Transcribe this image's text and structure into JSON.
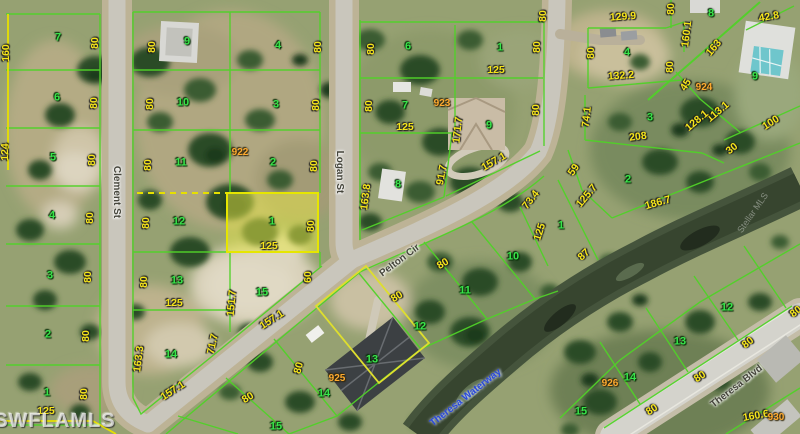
{
  "colors": {
    "lot_line": "#50d228",
    "highlight_line": "#e6e600",
    "highlight_fill": "#e8e84e",
    "dimension_text": "#f6e51a",
    "lot_number_text": "#38e44a",
    "parcel_id_text": "#ffab2e",
    "street_text": "#45453b",
    "waterway_text": "#2a49da"
  },
  "highlighted_parcel": {
    "lot": "1",
    "frontage": "125"
  },
  "labels": {
    "dimensions": [
      {
        "t": "160",
        "x": 6,
        "y": 53,
        "r": -90
      },
      {
        "t": "124",
        "x": 5,
        "y": 152,
        "r": -90
      },
      {
        "t": "125",
        "x": 46,
        "y": 411,
        "r": 0
      },
      {
        "t": "80",
        "x": 95,
        "y": 43,
        "r": -90
      },
      {
        "t": "80",
        "x": 94,
        "y": 103,
        "r": -90
      },
      {
        "t": "80",
        "x": 92,
        "y": 160,
        "r": -90
      },
      {
        "t": "80",
        "x": 90,
        "y": 218,
        "r": -90
      },
      {
        "t": "80",
        "x": 88,
        "y": 277,
        "r": -90
      },
      {
        "t": "80",
        "x": 86,
        "y": 336,
        "r": -90
      },
      {
        "t": "80",
        "x": 84,
        "y": 394,
        "r": -90
      },
      {
        "t": "80",
        "x": 152,
        "y": 47,
        "r": -90
      },
      {
        "t": "80",
        "x": 150,
        "y": 104,
        "r": -90
      },
      {
        "t": "80",
        "x": 148,
        "y": 165,
        "r": -90
      },
      {
        "t": "80",
        "x": 146,
        "y": 223,
        "r": -90
      },
      {
        "t": "80",
        "x": 144,
        "y": 282,
        "r": -90
      },
      {
        "t": "125",
        "x": 174,
        "y": 303,
        "r": 0
      },
      {
        "t": "163.3",
        "x": 139,
        "y": 359,
        "r": -83
      },
      {
        "t": "157.1",
        "x": 173,
        "y": 391,
        "r": -33
      },
      {
        "t": "71.7",
        "x": 213,
        "y": 344,
        "r": -78
      },
      {
        "t": "80",
        "x": 318,
        "y": 47,
        "r": -90
      },
      {
        "t": "80",
        "x": 316,
        "y": 105,
        "r": -90
      },
      {
        "t": "80",
        "x": 314,
        "y": 166,
        "r": -90
      },
      {
        "t": "80",
        "x": 311,
        "y": 226,
        "r": -90
      },
      {
        "t": "60",
        "x": 308,
        "y": 277,
        "r": -90
      },
      {
        "t": "151.7",
        "x": 232,
        "y": 303,
        "r": -85
      },
      {
        "t": "157.1",
        "x": 272,
        "y": 320,
        "r": -33
      },
      {
        "t": "125",
        "x": 269,
        "y": 246,
        "r": 0
      },
      {
        "t": "80",
        "x": 371,
        "y": 49,
        "r": -90
      },
      {
        "t": "80",
        "x": 369,
        "y": 106,
        "r": -90
      },
      {
        "t": "125",
        "x": 405,
        "y": 127,
        "r": 0
      },
      {
        "t": "163.8",
        "x": 366,
        "y": 197,
        "r": -83
      },
      {
        "t": "91.7",
        "x": 442,
        "y": 175,
        "r": -80
      },
      {
        "t": "80",
        "x": 537,
        "y": 47,
        "r": -90
      },
      {
        "t": "125",
        "x": 496,
        "y": 70,
        "r": 0
      },
      {
        "t": "80",
        "x": 536,
        "y": 110,
        "r": -90
      },
      {
        "t": "171.7",
        "x": 458,
        "y": 130,
        "r": -84
      },
      {
        "t": "157.1",
        "x": 494,
        "y": 162,
        "r": -30
      },
      {
        "t": "73.4",
        "x": 531,
        "y": 200,
        "r": -52
      },
      {
        "t": "80",
        "x": 543,
        "y": 16,
        "r": -90
      },
      {
        "t": "59",
        "x": 574,
        "y": 170,
        "r": -55
      },
      {
        "t": "125.7",
        "x": 587,
        "y": 196,
        "r": -50
      },
      {
        "t": "186.7",
        "x": 658,
        "y": 203,
        "r": -16
      },
      {
        "t": "125",
        "x": 540,
        "y": 232,
        "r": -72
      },
      {
        "t": "87",
        "x": 584,
        "y": 255,
        "r": -42
      },
      {
        "t": "80",
        "x": 671,
        "y": 9,
        "r": -90
      },
      {
        "t": "129.9",
        "x": 623,
        "y": 17,
        "r": -4
      },
      {
        "t": "160.1",
        "x": 687,
        "y": 34,
        "r": -83
      },
      {
        "t": "163",
        "x": 714,
        "y": 48,
        "r": -50
      },
      {
        "t": "42.8",
        "x": 769,
        "y": 17,
        "r": -10
      },
      {
        "t": "80",
        "x": 591,
        "y": 53,
        "r": -90
      },
      {
        "t": "80",
        "x": 670,
        "y": 67,
        "r": -90
      },
      {
        "t": "132.2",
        "x": 621,
        "y": 76,
        "r": -4
      },
      {
        "t": "45",
        "x": 686,
        "y": 85,
        "r": -58
      },
      {
        "t": "113.1",
        "x": 718,
        "y": 112,
        "r": -40
      },
      {
        "t": "128.1",
        "x": 697,
        "y": 121,
        "r": -40
      },
      {
        "t": "100",
        "x": 771,
        "y": 123,
        "r": -33
      },
      {
        "t": "208",
        "x": 638,
        "y": 137,
        "r": -7
      },
      {
        "t": "30",
        "x": 732,
        "y": 149,
        "r": -38
      },
      {
        "t": "74.1",
        "x": 587,
        "y": 117,
        "r": -84
      },
      {
        "t": "80",
        "x": 443,
        "y": 264,
        "r": -32
      },
      {
        "t": "80",
        "x": 397,
        "y": 297,
        "r": -32
      },
      {
        "t": "80",
        "x": 299,
        "y": 368,
        "r": -75
      },
      {
        "t": "80",
        "x": 248,
        "y": 398,
        "r": -32
      },
      {
        "t": "80",
        "x": 652,
        "y": 410,
        "r": -33
      },
      {
        "t": "80",
        "x": 700,
        "y": 377,
        "r": -33
      },
      {
        "t": "80",
        "x": 748,
        "y": 343,
        "r": -38
      },
      {
        "t": "80",
        "x": 796,
        "y": 312,
        "r": -38
      },
      {
        "t": "160.6",
        "x": 756,
        "y": 416,
        "r": -10
      }
    ],
    "lot_numbers": [
      {
        "t": "7",
        "x": 58,
        "y": 38
      },
      {
        "t": "6",
        "x": 57,
        "y": 98
      },
      {
        "t": "5",
        "x": 53,
        "y": 158
      },
      {
        "t": "4",
        "x": 52,
        "y": 216
      },
      {
        "t": "3",
        "x": 50,
        "y": 276
      },
      {
        "t": "2",
        "x": 48,
        "y": 335
      },
      {
        "t": "1",
        "x": 47,
        "y": 393
      },
      {
        "t": "9",
        "x": 187,
        "y": 42
      },
      {
        "t": "10",
        "x": 183,
        "y": 103
      },
      {
        "t": "11",
        "x": 181,
        "y": 163
      },
      {
        "t": "12",
        "x": 179,
        "y": 222
      },
      {
        "t": "13",
        "x": 177,
        "y": 281
      },
      {
        "t": "14",
        "x": 171,
        "y": 355
      },
      {
        "t": "4",
        "x": 278,
        "y": 46
      },
      {
        "t": "3",
        "x": 276,
        "y": 105
      },
      {
        "t": "2",
        "x": 273,
        "y": 163
      },
      {
        "t": "1",
        "x": 272,
        "y": 222
      },
      {
        "t": "15",
        "x": 262,
        "y": 293
      },
      {
        "t": "6",
        "x": 408,
        "y": 47
      },
      {
        "t": "1",
        "x": 500,
        "y": 48
      },
      {
        "t": "7",
        "x": 405,
        "y": 106
      },
      {
        "t": "9",
        "x": 489,
        "y": 126
      },
      {
        "t": "8",
        "x": 398,
        "y": 185
      },
      {
        "t": "4",
        "x": 627,
        "y": 53
      },
      {
        "t": "8",
        "x": 711,
        "y": 14
      },
      {
        "t": "9",
        "x": 755,
        "y": 77
      },
      {
        "t": "3",
        "x": 650,
        "y": 118
      },
      {
        "t": "2",
        "x": 628,
        "y": 180
      },
      {
        "t": "1",
        "x": 561,
        "y": 226
      },
      {
        "t": "10",
        "x": 513,
        "y": 257
      },
      {
        "t": "11",
        "x": 465,
        "y": 291
      },
      {
        "t": "12",
        "x": 420,
        "y": 327
      },
      {
        "t": "13",
        "x": 372,
        "y": 360
      },
      {
        "t": "14",
        "x": 324,
        "y": 394
      },
      {
        "t": "15",
        "x": 276,
        "y": 427
      },
      {
        "t": "12",
        "x": 727,
        "y": 308
      },
      {
        "t": "13",
        "x": 680,
        "y": 342
      },
      {
        "t": "14",
        "x": 630,
        "y": 378
      },
      {
        "t": "15",
        "x": 581,
        "y": 412
      }
    ],
    "parcel_ids": [
      {
        "t": "922",
        "x": 240,
        "y": 153
      },
      {
        "t": "923",
        "x": 442,
        "y": 104
      },
      {
        "t": "924",
        "x": 704,
        "y": 88
      },
      {
        "t": "925",
        "x": 337,
        "y": 379
      },
      {
        "t": "926",
        "x": 610,
        "y": 384
      },
      {
        "t": "930",
        "x": 776,
        "y": 418
      }
    ],
    "streets": [
      {
        "t": "Clement St",
        "x": 116,
        "y": 192,
        "r": 90
      },
      {
        "t": "Logan St",
        "x": 339,
        "y": 172,
        "r": 90
      },
      {
        "t": "Pelton Cir",
        "x": 400,
        "y": 261,
        "r": -37
      },
      {
        "t": "Theresa Waterway",
        "x": 466,
        "y": 398,
        "r": -38,
        "water": true
      },
      {
        "t": "Theresa Blvd",
        "x": 737,
        "y": 387,
        "r": -38
      }
    ],
    "watermarks": [
      {
        "t": "SWFLAMLS",
        "x": 55,
        "y": 421,
        "r": 0,
        "k": "wm"
      },
      {
        "t": "Stellar MLS",
        "x": 753,
        "y": 213,
        "r": -55,
        "k": "wm-faint"
      }
    ]
  }
}
